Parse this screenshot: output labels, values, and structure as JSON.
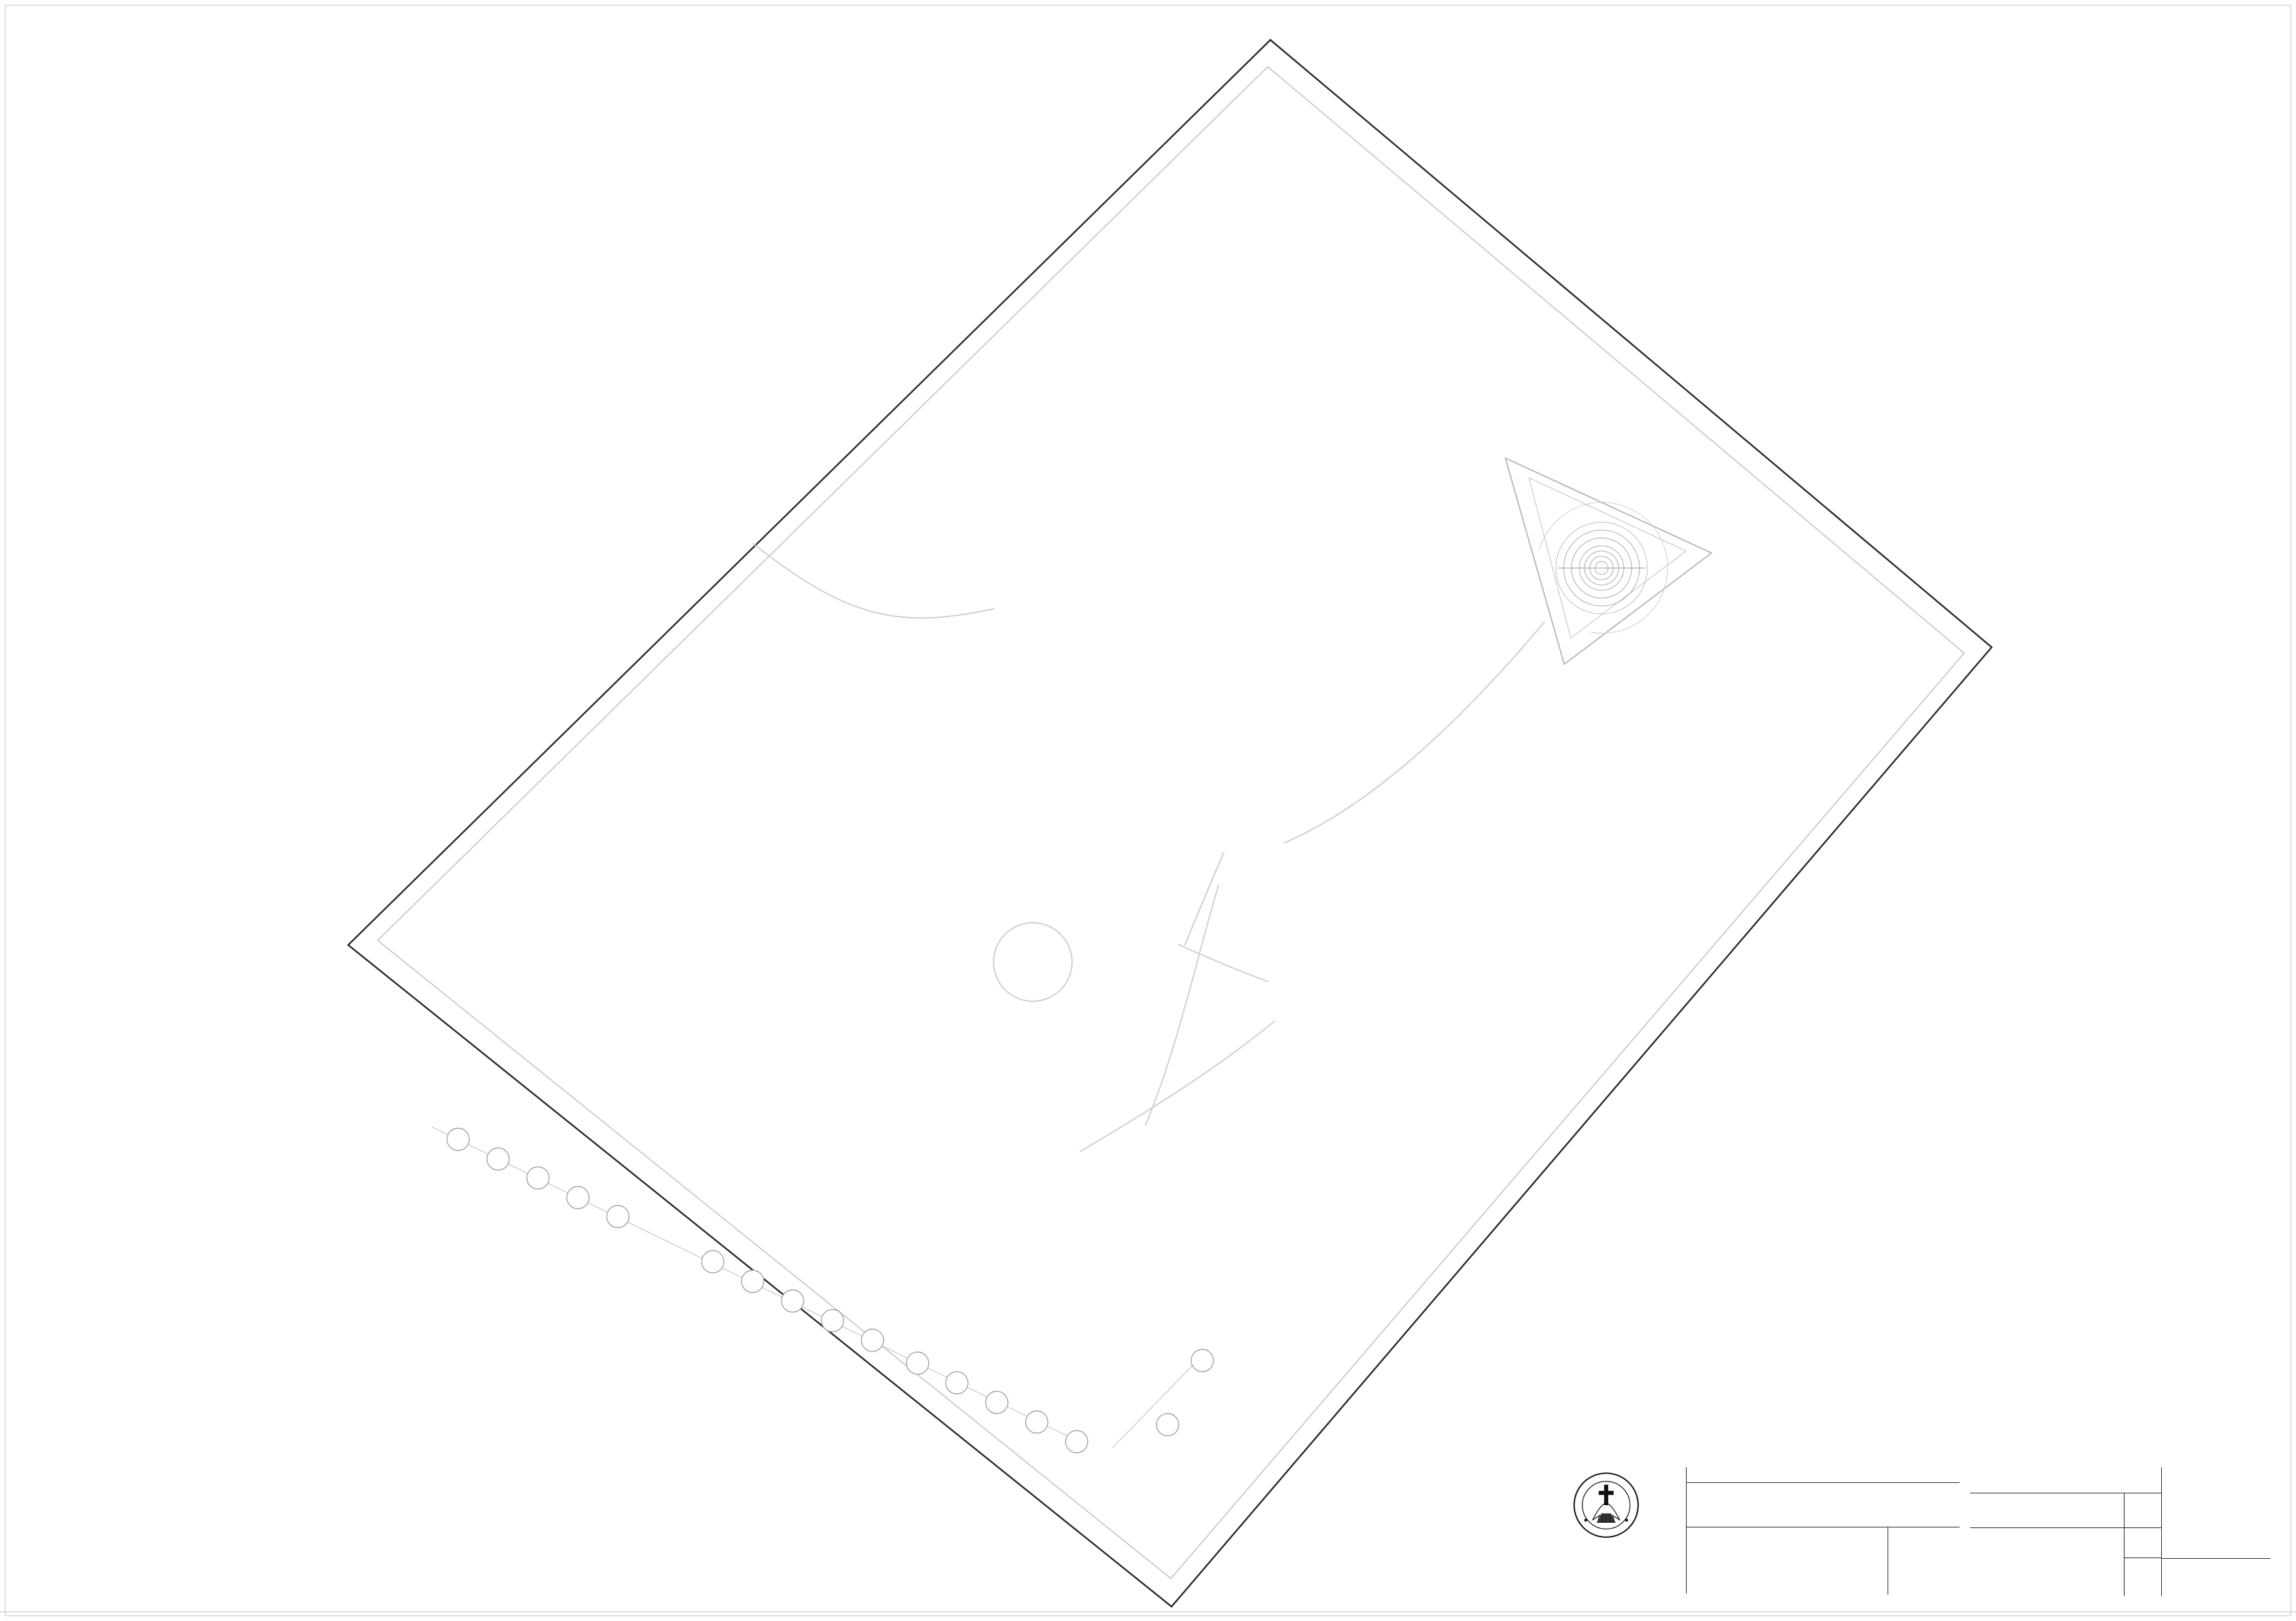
{
  "title_block": {
    "header": "TUGAS AKHIR - SEMESTER GENAP 2014/2015",
    "fields": {
      "judul_tugas": "JUDUL TUGAS",
      "judul_gambar": "JUDUL GAMBAR",
      "skala": "SKALA",
      "nama": "NAMA",
      "nrp": "NRP",
      "kelompok": "KELOMPOK",
      "mentor_utama": "MENTOR UTAMA",
      "mentor_pendamping": "MENTOR PENDAMPING",
      "lembar": "LEMBAR",
      "jumlah": "JUMLAH",
      "tanggal": "TANGGAL",
      "pengesahan": "PENGESAHAN"
    },
    "values": {
      "judul_tugas": "FASILITAS RETREAT DI CIREBON",
      "judul_gambar": "DENAH LANTAI 3",
      "skala": "1:200",
      "nama": "LEONARDO MATTHEW",
      "nrp": "B12190044",
      "kelompok": "7"
    },
    "mentors": {
      "utama": "IR. SAMUEL HARTONO, M.SC",
      "pendamping": [
        "ALTREROSJE, S.T., M.T.",
        "ELVINA S. WIJAYA, S.T., M.T."
      ]
    },
    "institution": [
      "PROGRAM STUDI ARSITEKTUR",
      "FAKULTAS TEKNIK SIPIL DAN PERENCANAAN",
      "UNIVERSITAS KRISTEN PETRA",
      "SURABAYA"
    ],
    "logo": {
      "top": "UNIVERSITAS KRISTEN",
      "bottom": "PETRA"
    }
  },
  "plan": {
    "rooms": [
      {
        "name": "MEETING  ROOM",
        "elev": "+9.50"
      },
      {
        "name": "SKY  AUDITORIUM",
        "elev": "+9.50"
      },
      {
        "name": "KELAS  WORKSHOP",
        "elev": "+9.50"
      },
      {
        "name": "HUNIAN  RETRET",
        "elev": "+9.00"
      },
      {
        "name": "HUNIAN  RETRET",
        "elev": "+9.00"
      },
      {
        "name": "HUNIAN  RETRET",
        "elev": "+9.00"
      }
    ],
    "grid_letters": [
      "A",
      "B",
      "C",
      "D",
      "E",
      "F",
      "G",
      "H",
      "I",
      "J",
      "K",
      "L",
      "M",
      "N",
      "O"
    ],
    "grid_numbers": [
      "1",
      "2"
    ],
    "dimensions": {
      "bay": "5000",
      "dim_8000": "8000",
      "dim_8500": "8500",
      "dim_7000": "7000",
      "dim_12000": "12000",
      "dim_6000": "6000"
    }
  }
}
